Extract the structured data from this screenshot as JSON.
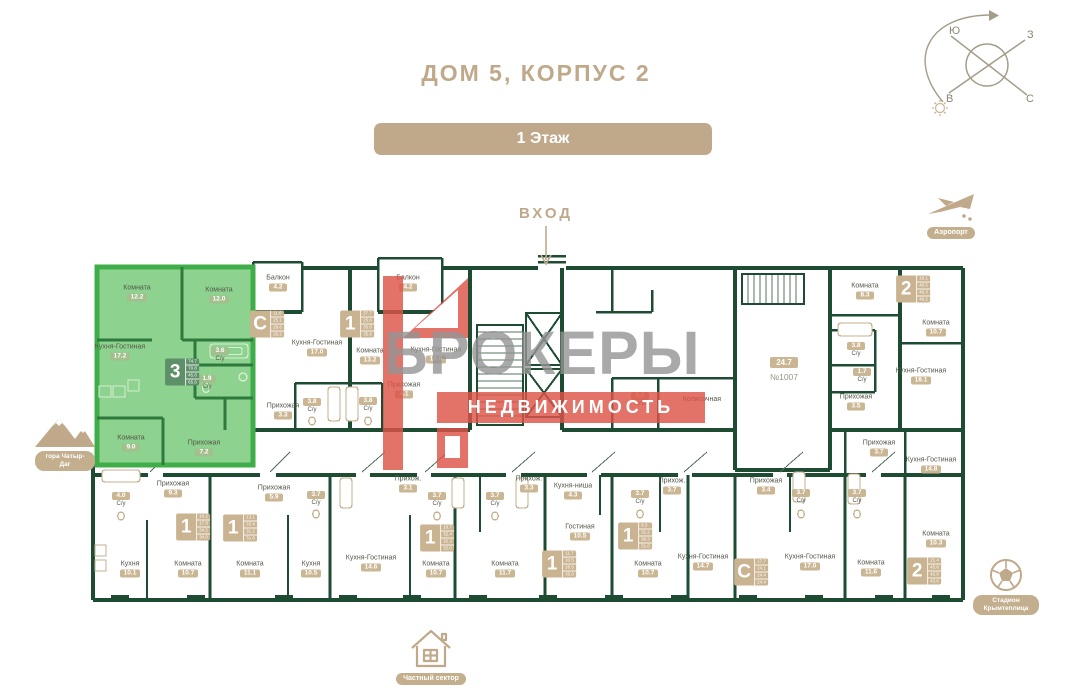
{
  "header": {
    "title": "ДОМ 5, КОРПУС 2",
    "floor_button": "1 Этаж"
  },
  "entrance": {
    "label": "ВХОД"
  },
  "compass": {
    "south": "Ю",
    "west": "З",
    "east": "В",
    "north": "С"
  },
  "watermark": {
    "line1": "БРОКЕРЫ",
    "line2": "НЕДВИЖИМОСТЬ"
  },
  "landmarks": {
    "mountain": {
      "label": "гора Чатыр-Даг"
    },
    "airport": {
      "label": "Аэропорт"
    },
    "stadium": {
      "label": "Стадион Крымтеплица"
    },
    "private_sector": {
      "label": "Частный сектор"
    }
  },
  "colors": {
    "brand_tan": "#bfa98a",
    "wall_green": "#1e4c33",
    "highlight_fill": "#8ed28f",
    "highlight_border": "#3fae4a",
    "badge_tan": "#cbb694",
    "watermark_red": "#dd5348",
    "watermark_gray": "#949494"
  },
  "floorplan": {
    "commercial": {
      "area": "24.7",
      "number": "№1007"
    },
    "stroller_room": "Колясочная",
    "rooms": [
      {
        "name": "Комната",
        "area": "12.2",
        "x": 137,
        "y": 293,
        "hl": true
      },
      {
        "name": "Комната",
        "area": "12.0",
        "x": 219,
        "y": 295,
        "hl": true
      },
      {
        "name": "Кухня-Гостиная",
        "area": "17.2",
        "x": 120,
        "y": 352,
        "hl": true
      },
      {
        "name": "С/у",
        "area": "3.6",
        "x": 220,
        "y": 355,
        "hl": true,
        "flip": true
      },
      {
        "name": "С/у",
        "area": "1.9",
        "x": 207,
        "y": 383,
        "hl": true,
        "flip": true
      },
      {
        "name": "Комната",
        "area": "9.0",
        "x": 131,
        "y": 443,
        "hl": true
      },
      {
        "name": "Прихожая",
        "area": "7.2",
        "x": 204,
        "y": 448,
        "hl": true
      },
      {
        "name": "Балкон",
        "area": "4.2",
        "x": 278,
        "y": 283
      },
      {
        "name": "Кухня-Гостиная",
        "area": "17.0",
        "x": 317,
        "y": 348
      },
      {
        "name": "Прихожая",
        "area": "3.3",
        "x": 283,
        "y": 411
      },
      {
        "name": "С/у",
        "area": "3.8",
        "x": 312,
        "y": 406,
        "flip": true
      },
      {
        "name": "Балкон",
        "area": "4.2",
        "x": 408,
        "y": 283
      },
      {
        "name": "Комната",
        "area": "13.2",
        "x": 370,
        "y": 356
      },
      {
        "name": "Кухня-Гостиная",
        "area": "14.6",
        "x": 436,
        "y": 355
      },
      {
        "name": "Прихожая",
        "area": "4.1",
        "x": 404,
        "y": 390
      },
      {
        "name": "С/у",
        "area": "3.8",
        "x": 368,
        "y": 405,
        "flip": true
      },
      {
        "name": "КУИ",
        "area": "5.0",
        "x": 640,
        "y": 400,
        "flip": true
      },
      {
        "name": "Колясочная",
        "area": "",
        "x": 702,
        "y": 400
      },
      {
        "name": "Комната",
        "area": "8.3",
        "x": 865,
        "y": 291
      },
      {
        "name": "С/у",
        "area": "3.8",
        "x": 856,
        "y": 350,
        "flip": true
      },
      {
        "name": "С/у",
        "area": "1.7",
        "x": 862,
        "y": 376,
        "flip": true
      },
      {
        "name": "Прихожая",
        "area": "3.5",
        "x": 856,
        "y": 402
      },
      {
        "name": "Комната",
        "area": "10.7",
        "x": 936,
        "y": 328
      },
      {
        "name": "Кухня-Гостиная",
        "area": "18.1",
        "x": 921,
        "y": 376
      },
      {
        "name": "Прихожая",
        "area": "3.7",
        "x": 879,
        "y": 448
      },
      {
        "name": "Кухня-Гостиная",
        "area": "14.8",
        "x": 931,
        "y": 465
      },
      {
        "name": "Комната",
        "area": "10.3",
        "x": 936,
        "y": 539
      },
      {
        "name": "Комната",
        "area": "11.6",
        "x": 871,
        "y": 568
      },
      {
        "name": "С/у",
        "area": "4.0",
        "x": 121,
        "y": 500,
        "flip": true
      },
      {
        "name": "Прихожая",
        "area": "9.3",
        "x": 173,
        "y": 489
      },
      {
        "name": "Кухня",
        "area": "10.1",
        "x": 130,
        "y": 569
      },
      {
        "name": "Комната",
        "area": "10.7",
        "x": 188,
        "y": 569
      },
      {
        "name": "Прихожая",
        "area": "5.9",
        "x": 274,
        "y": 493
      },
      {
        "name": "Комната",
        "area": "11.1",
        "x": 250,
        "y": 569
      },
      {
        "name": "С/у",
        "area": "3.7",
        "x": 316,
        "y": 499,
        "flip": true
      },
      {
        "name": "Кухня",
        "area": "10.5",
        "x": 311,
        "y": 569
      },
      {
        "name": "Кухня-Гостиная",
        "area": "14.6",
        "x": 371,
        "y": 563
      },
      {
        "name": "Прихож.",
        "area": "3.1",
        "x": 408,
        "y": 484
      },
      {
        "name": "С/у",
        "area": "3.7",
        "x": 437,
        "y": 500,
        "flip": true
      },
      {
        "name": "Комната",
        "area": "10.7",
        "x": 436,
        "y": 569
      },
      {
        "name": "Прихож.",
        "area": "3.3",
        "x": 529,
        "y": 484
      },
      {
        "name": "С/у",
        "area": "3.7",
        "x": 495,
        "y": 500,
        "flip": true
      },
      {
        "name": "Комната",
        "area": "11.7",
        "x": 505,
        "y": 569
      },
      {
        "name": "Кухня-ниша",
        "area": "4.3",
        "x": 573,
        "y": 491
      },
      {
        "name": "Гостиная",
        "area": "10.5",
        "x": 580,
        "y": 532
      },
      {
        "name": "С/у",
        "area": "3.7",
        "x": 640,
        "y": 498,
        "flip": true
      },
      {
        "name": "Прихож.",
        "area": "3.7",
        "x": 672,
        "y": 486
      },
      {
        "name": "Комната",
        "area": "10.7",
        "x": 648,
        "y": 569
      },
      {
        "name": "Кухня-Гостиная",
        "area": "14.7",
        "x": 703,
        "y": 562
      },
      {
        "name": "Прихожая",
        "area": "3.4",
        "x": 766,
        "y": 486
      },
      {
        "name": "С/у",
        "area": "3.7",
        "x": 801,
        "y": 497,
        "flip": true
      },
      {
        "name": "С/у",
        "area": "3.7",
        "x": 857,
        "y": 497,
        "flip": true
      },
      {
        "name": "Кухня-Гостиная",
        "area": "17.0",
        "x": 810,
        "y": 562
      }
    ],
    "badges": [
      {
        "label": "3",
        "x": 182,
        "y": 372,
        "areas": [
          "74.7",
          "70.8",
          "45.6",
          "65.6"
        ],
        "hl": true
      },
      {
        "label": "С",
        "x": 267,
        "y": 324,
        "areas": [
          "11.0",
          "25.1",
          "29.6",
          "28.2"
        ]
      },
      {
        "label": "1",
        "x": 357,
        "y": 324,
        "areas": [
          "37.7",
          "25.6",
          "35.8",
          "35.6"
        ]
      },
      {
        "label": "2",
        "x": 913,
        "y": 289,
        "areas": [
          "19.1",
          "46.5",
          "46.3",
          "46.2"
        ]
      },
      {
        "label": "2",
        "x": 924,
        "y": 571,
        "areas": [
          "21.4",
          "45.6",
          "42.0",
          "43.6"
        ]
      },
      {
        "label": "1",
        "x": 193,
        "y": 527,
        "areas": [
          "10.2",
          "17.8",
          "34.2",
          "34.0"
        ]
      },
      {
        "label": "1",
        "x": 240,
        "y": 528,
        "areas": [
          "13.1",
          "33.4",
          "31.2",
          "31.0"
        ]
      },
      {
        "label": "1",
        "x": 437,
        "y": 538,
        "areas": [
          "10.7",
          "32.4",
          "32.3",
          "32.0"
        ]
      },
      {
        "label": "1",
        "x": 559,
        "y": 564,
        "areas": [
          "11.7",
          "33.5",
          "28.5",
          "35.0"
        ]
      },
      {
        "label": "1",
        "x": 635,
        "y": 536,
        "areas": [
          "9.3",
          "31.2",
          "30.3",
          "31.0"
        ]
      },
      {
        "label": "С",
        "x": 751,
        "y": 572,
        "areas": [
          "17.7",
          "24.1",
          "24.4",
          "24.4"
        ]
      }
    ]
  }
}
